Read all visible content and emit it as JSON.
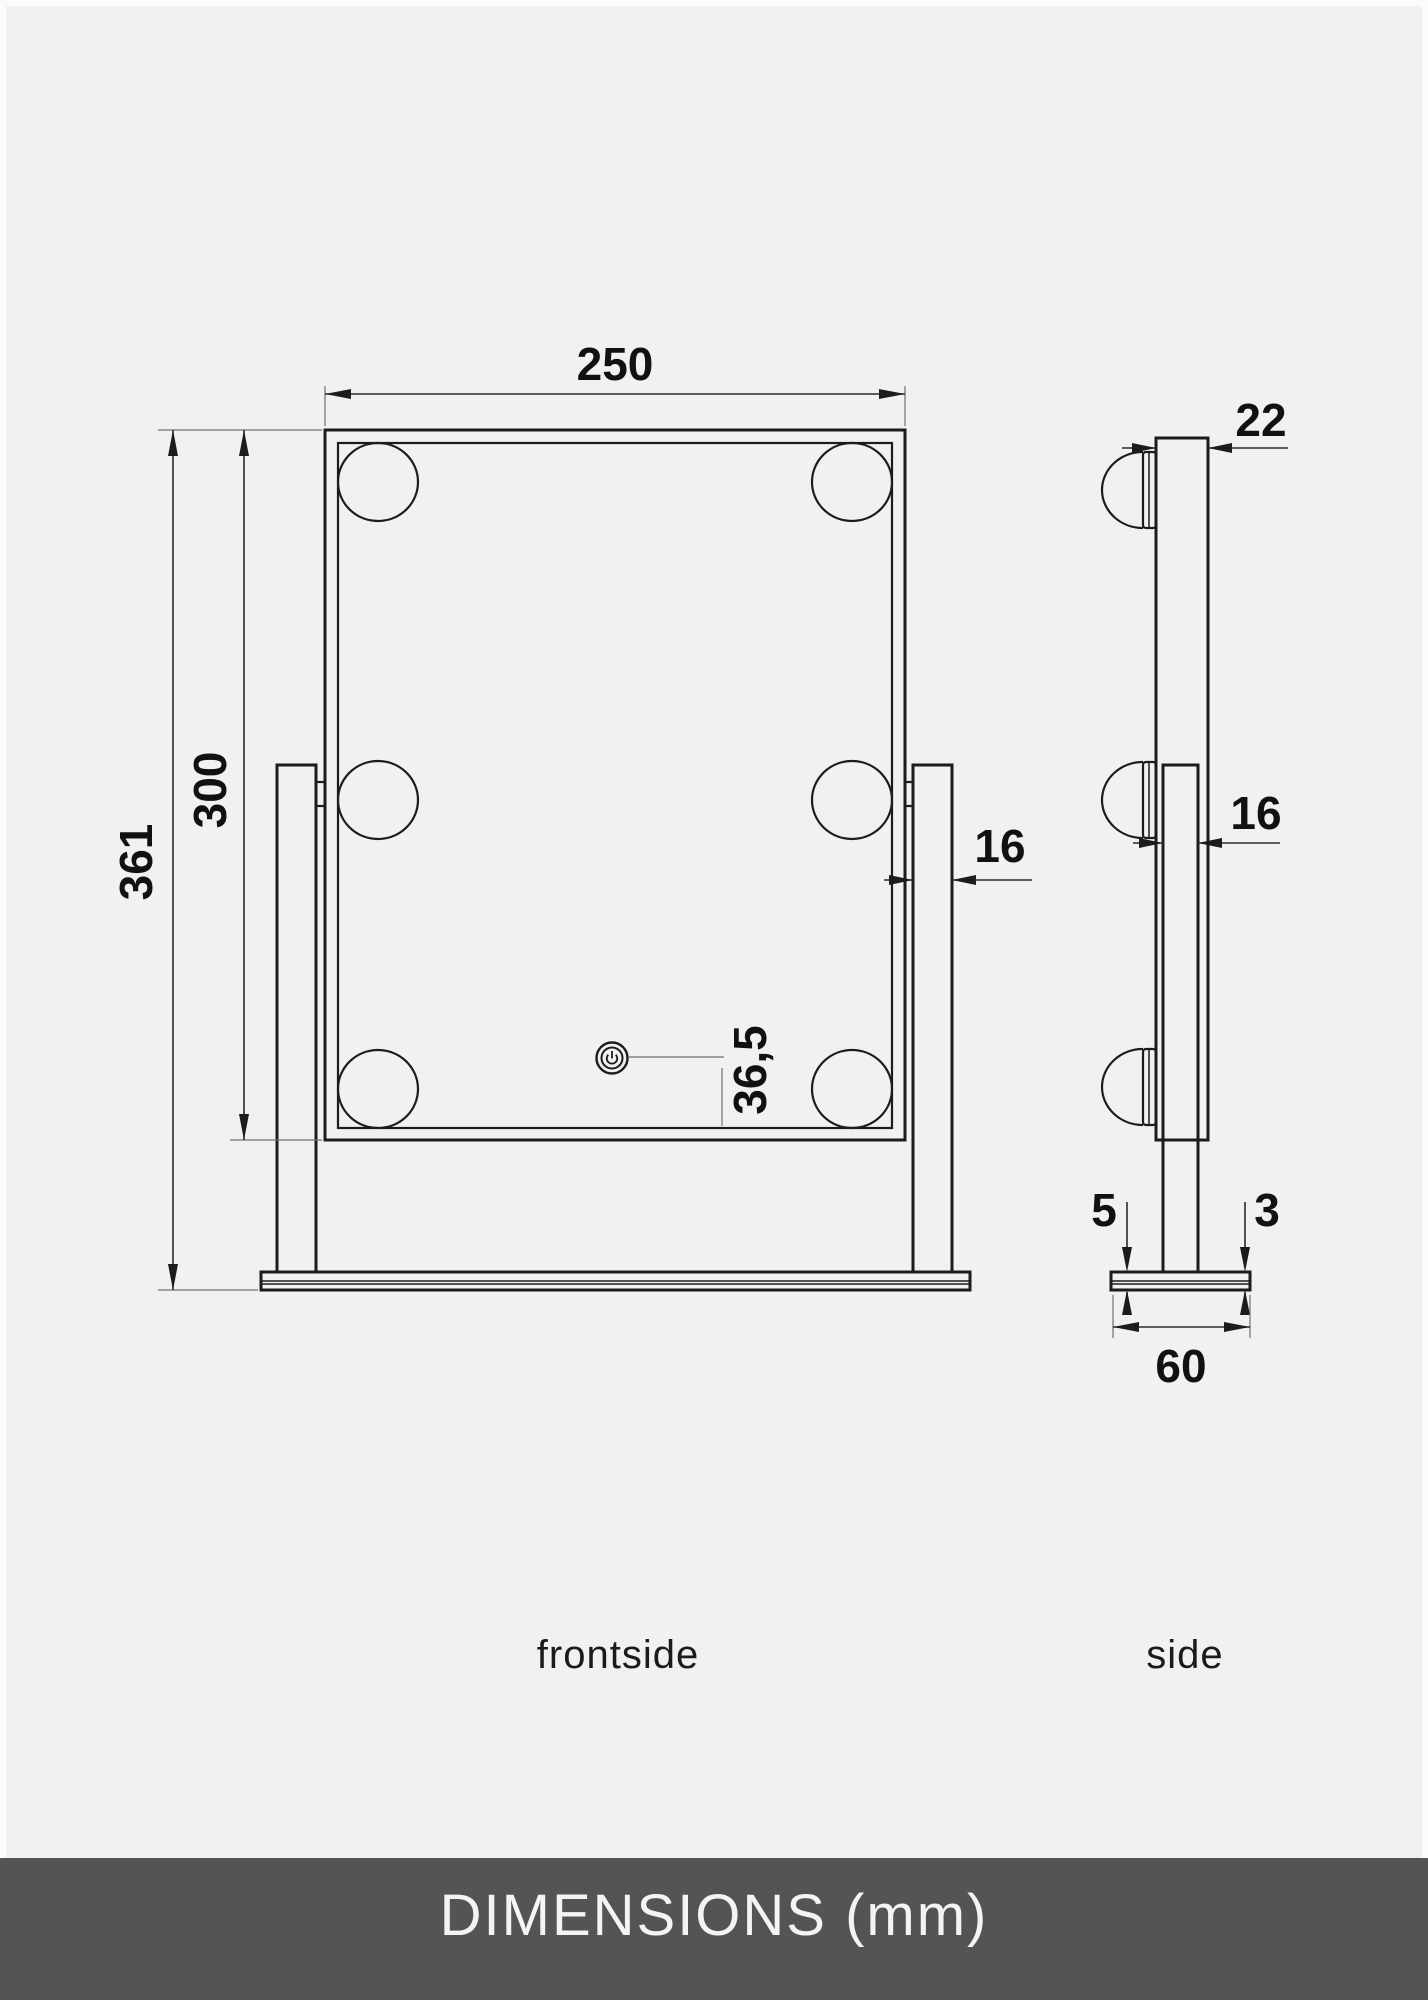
{
  "drawing": {
    "front_view": {
      "label": "frontside",
      "dimensions": {
        "width": "250",
        "mirror_height": "300",
        "total_height": "361",
        "arm_width": "16",
        "power_button_offset": "36,5"
      },
      "bulb_count": 6,
      "power_icon": "power-symbol"
    },
    "side_view": {
      "label": "side",
      "dimensions": {
        "depth": "22",
        "arm_width": "16",
        "base_plate_thickness": "5",
        "base_pad_thickness": "3",
        "base_depth": "60"
      },
      "bulb_count": 3
    },
    "colors": {
      "background": "#f1f1f2",
      "line": "#1c1c1c",
      "dimension_line": "#2a2a2a",
      "banner_background": "#545456",
      "banner_text": "#f4f4f4"
    }
  },
  "footer": {
    "title": "DIMENSIONS (mm)"
  }
}
